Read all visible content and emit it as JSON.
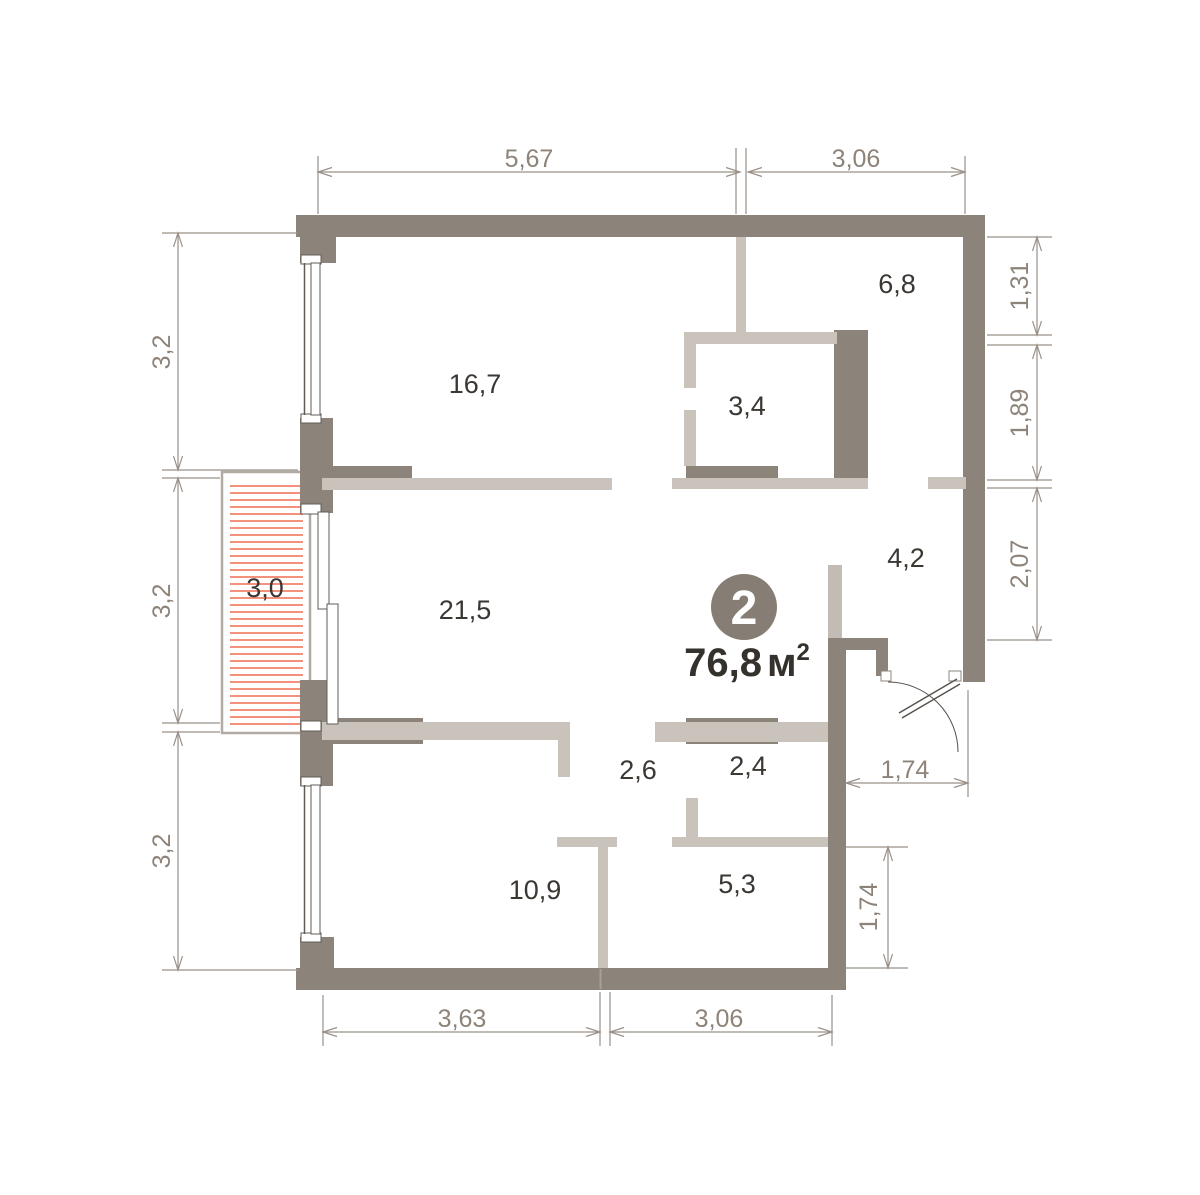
{
  "palette": {
    "wall": "#8c847b",
    "partition": "#c9c3bb",
    "balcony_border": "#b2aba3",
    "balcony_hatch": "#f4917c",
    "dim_lines": "#9a9089",
    "dim_text": "#8d8379",
    "room_text": "#3b3733",
    "badge_fill": "#867e74",
    "badge_text": "#ffffff",
    "area_text": "#35312c"
  },
  "unit_badge": {
    "number": "2",
    "area_value": "76,8",
    "area_unit": "м",
    "area_sup": "2",
    "cx": 744,
    "cy": 607,
    "r": 33,
    "area_x": 747,
    "area_y": 676
  },
  "rooms": [
    {
      "label": "16,7",
      "x": 475,
      "y": 384
    },
    {
      "label": "6,8",
      "x": 897,
      "y": 284
    },
    {
      "label": "3,4",
      "x": 747,
      "y": 406
    },
    {
      "label": "4,2",
      "x": 906,
      "y": 558
    },
    {
      "label": "21,5",
      "x": 465,
      "y": 610
    },
    {
      "label": "3,0",
      "x": 265,
      "y": 588
    },
    {
      "label": "2,6",
      "x": 638,
      "y": 770
    },
    {
      "label": "2,4",
      "x": 748,
      "y": 766
    },
    {
      "label": "10,9",
      "x": 535,
      "y": 890
    },
    {
      "label": "5,3",
      "x": 737,
      "y": 884
    }
  ],
  "dimensions": [
    {
      "label": "5,67",
      "x1": 318,
      "y1": 172,
      "x2": 740,
      "y2": 172,
      "lx": 529,
      "ly": 158,
      "rot": 0,
      "ext": [
        [
          318,
          156,
          318,
          214
        ],
        [
          736,
          148,
          736,
          214
        ],
        [
          746,
          148,
          746,
          214
        ]
      ]
    },
    {
      "label": "3,06",
      "x1": 748,
      "y1": 172,
      "x2": 965,
      "y2": 172,
      "lx": 856,
      "ly": 158,
      "rot": 0,
      "ext": [
        [
          965,
          156,
          965,
          214
        ]
      ]
    },
    {
      "label": "3,2",
      "x1": 178,
      "y1": 233,
      "x2": 178,
      "y2": 470,
      "lx": 161,
      "ly": 352,
      "rot": -90,
      "ext": [
        [
          162,
          233,
          298,
          233
        ],
        [
          162,
          470,
          298,
          470
        ]
      ]
    },
    {
      "label": "3,2",
      "x1": 178,
      "y1": 478,
      "x2": 178,
      "y2": 723,
      "lx": 161,
      "ly": 601,
      "rot": -90,
      "ext": [
        [
          162,
          478,
          220,
          478
        ],
        [
          162,
          723,
          220,
          723
        ]
      ]
    },
    {
      "label": "3,2",
      "x1": 178,
      "y1": 732,
      "x2": 178,
      "y2": 970,
      "lx": 161,
      "ly": 851,
      "rot": -90,
      "ext": [
        [
          162,
          732,
          220,
          732
        ],
        [
          162,
          970,
          298,
          970
        ]
      ]
    },
    {
      "label": "1,31",
      "x1": 1037,
      "y1": 237,
      "x2": 1037,
      "y2": 335,
      "lx": 1019,
      "ly": 286,
      "rot": -90,
      "ext": [
        [
          987,
          237,
          1052,
          237
        ],
        [
          987,
          335,
          1052,
          335
        ]
      ]
    },
    {
      "label": "1,89",
      "x1": 1037,
      "y1": 345,
      "x2": 1037,
      "y2": 480,
      "lx": 1019,
      "ly": 413,
      "rot": -90,
      "ext": [
        [
          987,
          345,
          1052,
          345
        ],
        [
          987,
          480,
          1052,
          480
        ]
      ]
    },
    {
      "label": "2,07",
      "x1": 1037,
      "y1": 488,
      "x2": 1037,
      "y2": 640,
      "lx": 1019,
      "ly": 564,
      "rot": -90,
      "ext": [
        [
          987,
          488,
          1052,
          488
        ],
        [
          987,
          640,
          1052,
          640
        ]
      ]
    },
    {
      "label": "1,74",
      "x1": 846,
      "y1": 783,
      "x2": 968,
      "y2": 783,
      "lx": 905,
      "ly": 769,
      "rot": 0,
      "ext": [
        [
          968,
          690,
          968,
          797
        ]
      ]
    },
    {
      "label": "1,74",
      "x1": 888,
      "y1": 847,
      "x2": 888,
      "y2": 968,
      "lx": 868,
      "ly": 907,
      "rot": -90,
      "ext": [
        [
          846,
          847,
          908,
          847
        ],
        [
          846,
          968,
          908,
          968
        ]
      ]
    },
    {
      "label": "3,63",
      "x1": 323,
      "y1": 1032,
      "x2": 600,
      "y2": 1032,
      "lx": 462,
      "ly": 1018,
      "rot": 0,
      "ext": [
        [
          323,
          995,
          323,
          1046
        ],
        [
          600,
          992,
          600,
          1046
        ],
        [
          610,
          992,
          610,
          1046
        ]
      ]
    },
    {
      "label": "3,06",
      "x1": 610,
      "y1": 1032,
      "x2": 832,
      "y2": 1032,
      "lx": 719,
      "ly": 1018,
      "rot": 0,
      "ext": [
        [
          832,
          995,
          832,
          1046
        ]
      ]
    }
  ],
  "balcony": {
    "x": 222,
    "y": 472,
    "w": 88,
    "h": 261,
    "hatch_x1": 230,
    "hatch_x2": 303,
    "hatch_y1": 486,
    "hatch_y2": 726,
    "hatch_step": 7
  }
}
